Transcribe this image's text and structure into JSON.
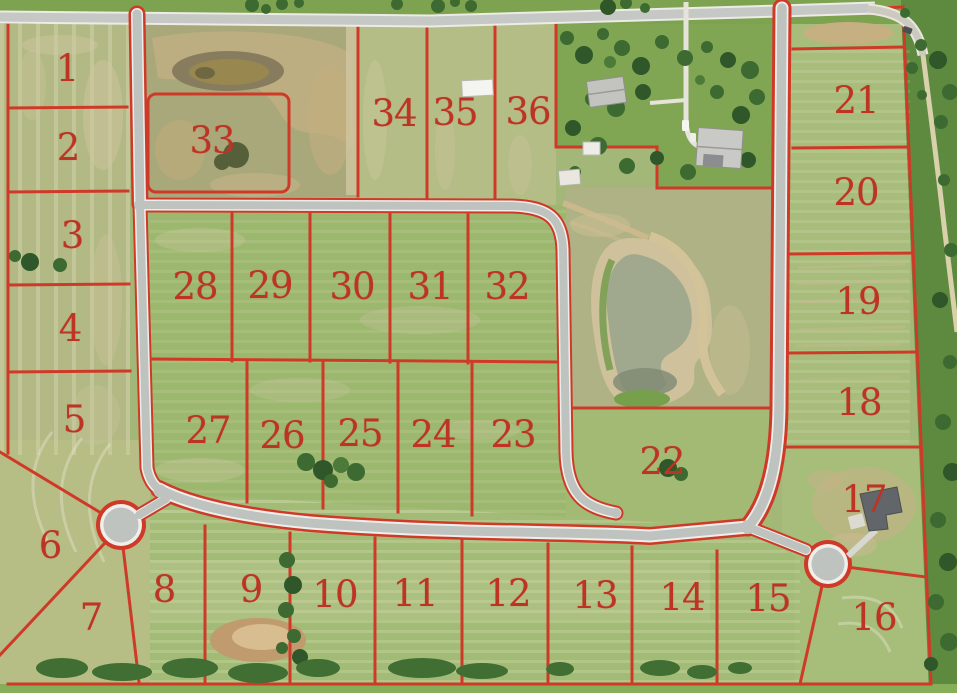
{
  "map": {
    "description": "Aerial photograph of a subdivision plat with numbered lots outlined in red",
    "lot_count": 36,
    "line_color": "#cf3a28",
    "label_color": "#bd3425",
    "road_color": "#c3c6c2",
    "pond_color": "#a0a88d",
    "features": [
      "pond",
      "west-cul-de-sac",
      "east-cul-de-sac",
      "farmstead-houses",
      "white-barn",
      "existing-house-lot17",
      "dirt-pond"
    ],
    "lots": [
      {
        "n": "1",
        "x": 67,
        "y": 70
      },
      {
        "n": "2",
        "x": 68,
        "y": 149
      },
      {
        "n": "3",
        "x": 72,
        "y": 237
      },
      {
        "n": "4",
        "x": 70,
        "y": 330
      },
      {
        "n": "5",
        "x": 74,
        "y": 421
      },
      {
        "n": "6",
        "x": 50,
        "y": 547
      },
      {
        "n": "7",
        "x": 91,
        "y": 619
      },
      {
        "n": "8",
        "x": 164,
        "y": 591
      },
      {
        "n": "9",
        "x": 251,
        "y": 591
      },
      {
        "n": "10",
        "x": 335,
        "y": 596
      },
      {
        "n": "11",
        "x": 415,
        "y": 595
      },
      {
        "n": "12",
        "x": 508,
        "y": 595
      },
      {
        "n": "13",
        "x": 595,
        "y": 597
      },
      {
        "n": "14",
        "x": 682,
        "y": 599
      },
      {
        "n": "15",
        "x": 768,
        "y": 600
      },
      {
        "n": "16",
        "x": 874,
        "y": 619
      },
      {
        "n": "17",
        "x": 864,
        "y": 501
      },
      {
        "n": "18",
        "x": 859,
        "y": 404
      },
      {
        "n": "19",
        "x": 858,
        "y": 303
      },
      {
        "n": "20",
        "x": 856,
        "y": 194
      },
      {
        "n": "21",
        "x": 856,
        "y": 102
      },
      {
        "n": "22",
        "x": 662,
        "y": 463
      },
      {
        "n": "23",
        "x": 513,
        "y": 436
      },
      {
        "n": "24",
        "x": 433,
        "y": 436
      },
      {
        "n": "25",
        "x": 360,
        "y": 435
      },
      {
        "n": "26",
        "x": 282,
        "y": 437
      },
      {
        "n": "27",
        "x": 208,
        "y": 432
      },
      {
        "n": "28",
        "x": 195,
        "y": 288
      },
      {
        "n": "29",
        "x": 270,
        "y": 287
      },
      {
        "n": "30",
        "x": 352,
        "y": 288
      },
      {
        "n": "31",
        "x": 430,
        "y": 288
      },
      {
        "n": "32",
        "x": 507,
        "y": 288
      },
      {
        "n": "33",
        "x": 212,
        "y": 142
      },
      {
        "n": "34",
        "x": 394,
        "y": 115
      },
      {
        "n": "35",
        "x": 455,
        "y": 114
      },
      {
        "n": "36",
        "x": 528,
        "y": 113
      }
    ]
  }
}
